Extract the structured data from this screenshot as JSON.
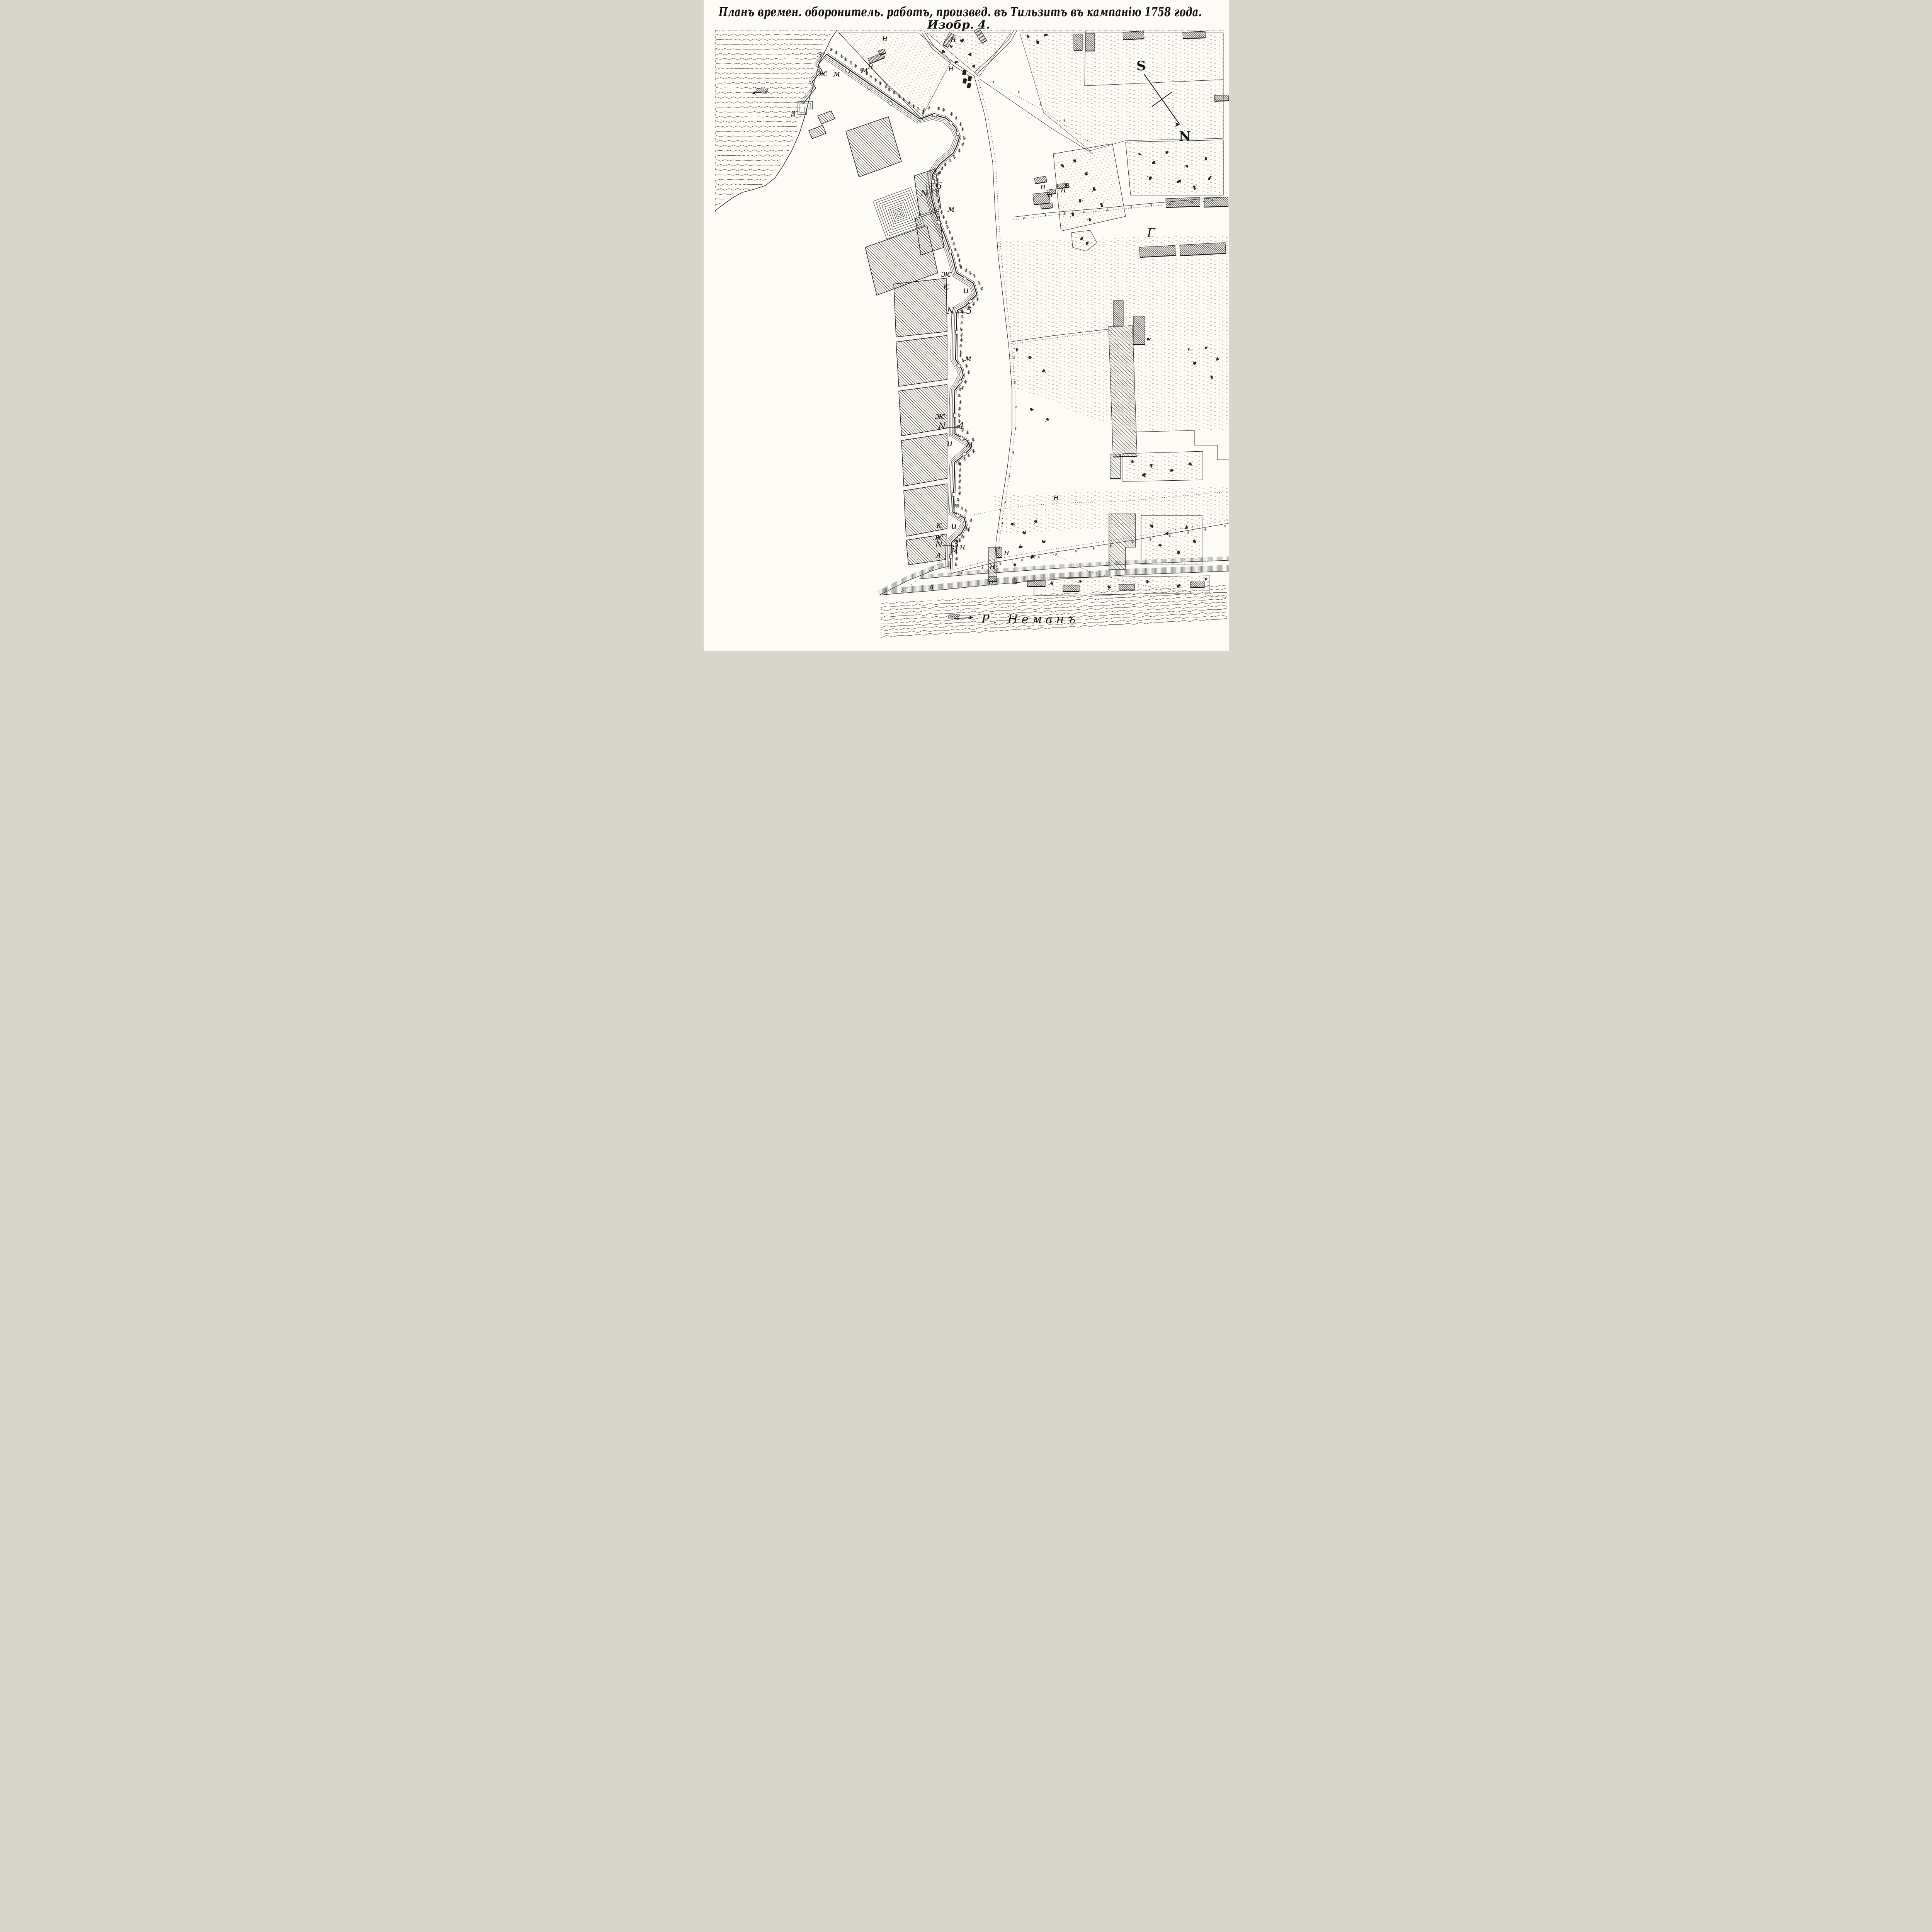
{
  "title": {
    "line1": "Планъ времен. оборонитель. работъ, произвед. въ Тильзитъ въ кампанію 1758 года.",
    "line2": "Изобр. 4."
  },
  "compass": {
    "south": "S",
    "north": "N"
  },
  "river": {
    "name": "Р. Неманъ"
  },
  "marks": {
    "z": "з",
    "zh": "ж",
    "m": "м",
    "n": "н",
    "k": "к",
    "i": "и",
    "l": "л",
    "g": "Г",
    "no": "N"
  },
  "works": {
    "no6": "6",
    "no5": "5",
    "no4": "4",
    "no3": "3"
  },
  "icons": {
    "compass_needle": "arrow-se",
    "flow_arrow_tilse": "arrow-left",
    "flow_arrow_neman": "arrow-right"
  },
  "colors": {
    "ink": "#1b1916",
    "paper": "#fcfbf6"
  }
}
